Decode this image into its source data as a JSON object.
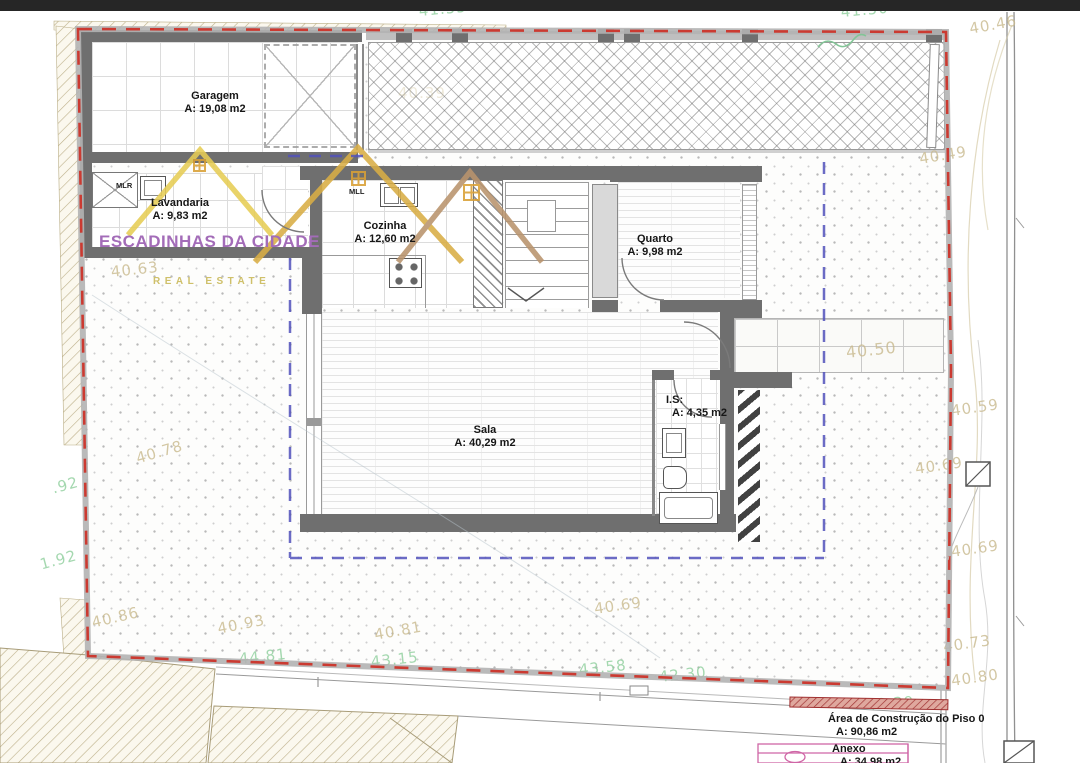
{
  "plan": {
    "rooms": [
      {
        "name": "Garagem",
        "area": "A: 19,08 m2"
      },
      {
        "name": "Lavandaria",
        "area": "A: 9,83 m2"
      },
      {
        "name": "Cozinha",
        "area": "A: 12,60 m2"
      },
      {
        "name": "Quarto",
        "area": "A: 9,98 m2"
      },
      {
        "name": "Sala",
        "area": "A: 40,29 m2"
      },
      {
        "name": "I.S:",
        "area": "A: 4,35 m2"
      }
    ],
    "appliance_labels": {
      "mlr": "MLR",
      "mll": "MLL"
    },
    "summary": [
      {
        "name": "Área de Construção do Piso 0",
        "area": "A: 90,86 m2"
      },
      {
        "name": "Anexo",
        "area": "A: 34,98 m2"
      }
    ],
    "elev_tan": [
      "40.46",
      "40.49",
      "40.39",
      "40.63",
      "40.78",
      "40.50",
      "40.59",
      "40.69",
      "40.86",
      "40.93",
      "40.81",
      "40.69",
      "40.73",
      "40.80",
      "40.69"
    ],
    "elev_green": [
      "41.55",
      "41.50",
      ".92",
      "1.92",
      "44.81",
      "43.15",
      "43.58",
      "42.30",
      "42.29"
    ],
    "watermark": {
      "title": "ESCADINHAS DA CIDADE",
      "subtitle": "REAL ESTATE"
    },
    "colors": {
      "boundary_red": "#cb3a31",
      "overlay_blue": "#5252bc",
      "wall_gray": "#6f6f6f",
      "elevation_tan": "#c9ba8e",
      "elevation_green": "#8fcf9d",
      "logo_purple": "#a36cb8",
      "logo_gold": "#d4a844"
    }
  }
}
